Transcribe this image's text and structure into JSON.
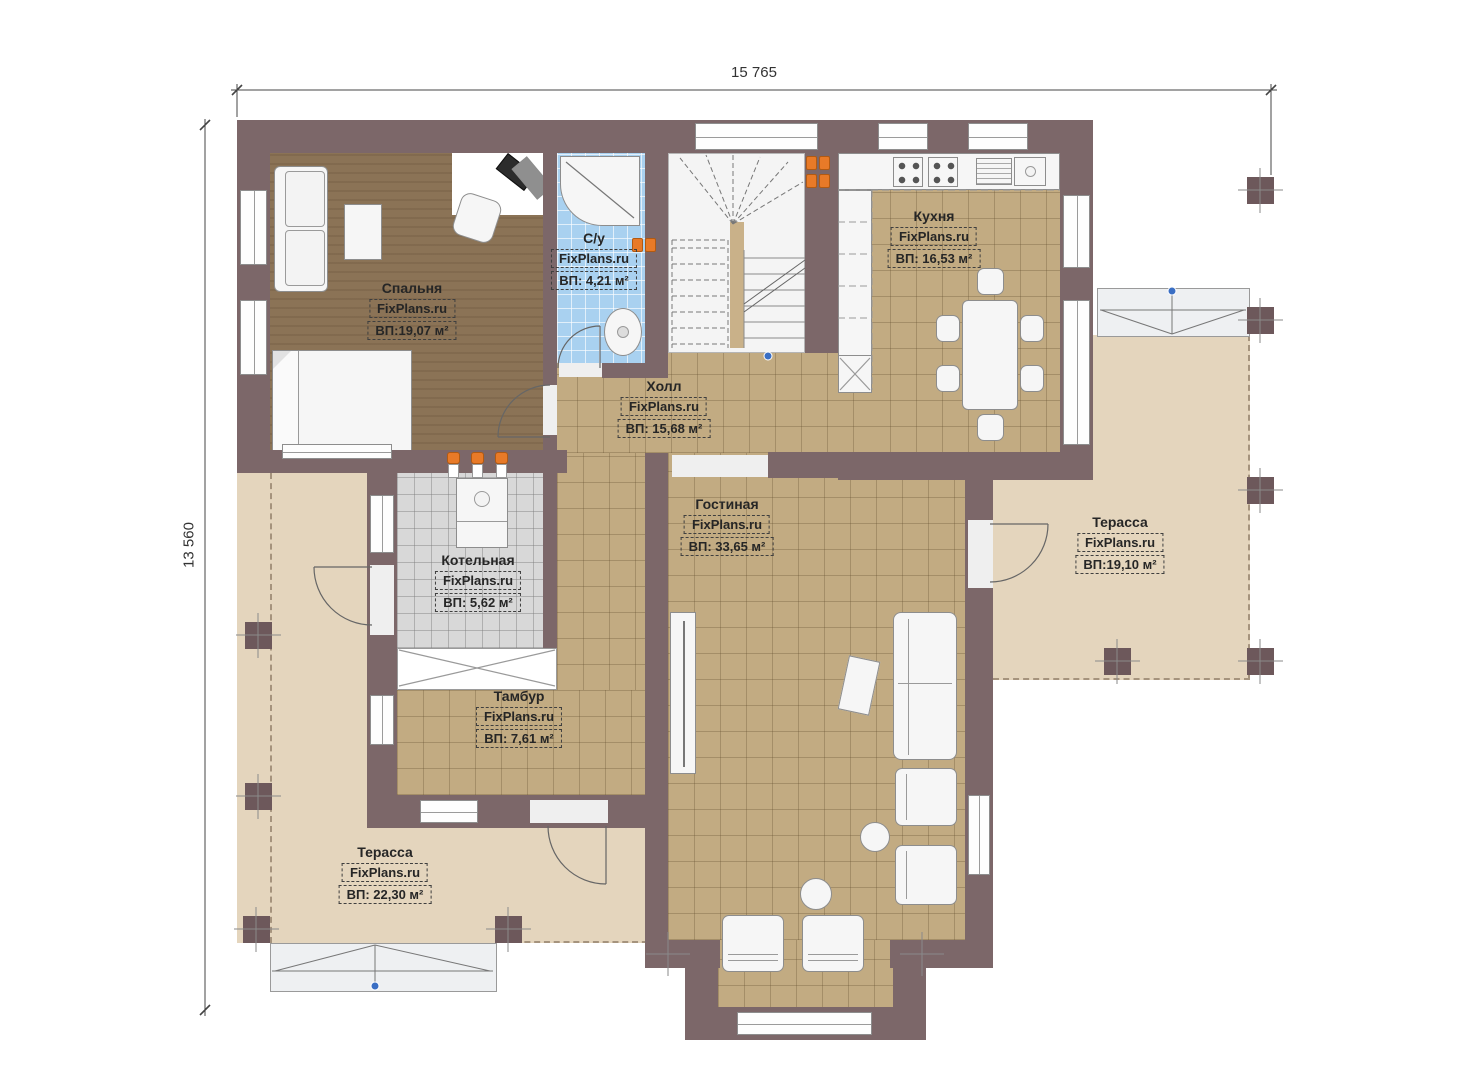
{
  "dimensions": {
    "width_label": "15 765",
    "height_label": "13 560"
  },
  "watermark": "FixPlans.ru",
  "rooms": [
    {
      "key": "bedroom",
      "name": "Спальня",
      "area": "ВП:19,07 м²"
    },
    {
      "key": "bathroom",
      "name": "С/у",
      "area": "ВП: 4,21 м²"
    },
    {
      "key": "kitchen",
      "name": "Кухня",
      "area": "ВП: 16,53 м²"
    },
    {
      "key": "hall",
      "name": "Холл",
      "area": "ВП: 15,68 м²"
    },
    {
      "key": "boiler_room",
      "name": "Котельная",
      "area": "ВП: 5,62 м²"
    },
    {
      "key": "living_room",
      "name": "Гостиная",
      "area": "ВП: 33,65 м²"
    },
    {
      "key": "vestibule",
      "name": "Тамбур",
      "area": "ВП: 7,61 м²"
    },
    {
      "key": "terrace_right",
      "name": "Терасса",
      "area": "ВП:19,10 м²"
    },
    {
      "key": "terrace_bottom",
      "name": "Терасса",
      "area": "ВП: 22,30 м²"
    }
  ],
  "colors": {
    "wall": "#7c6769",
    "tile_floor": "#c2ab82",
    "bedroom_floor": "#8b7356",
    "bathroom_floor": "#a9d1f0",
    "boiler_floor": "#d8d8d8",
    "terrace_floor": "#e4d5bd",
    "radiator_accent": "#e87a28",
    "marker_blue": "#3a6fc4"
  }
}
